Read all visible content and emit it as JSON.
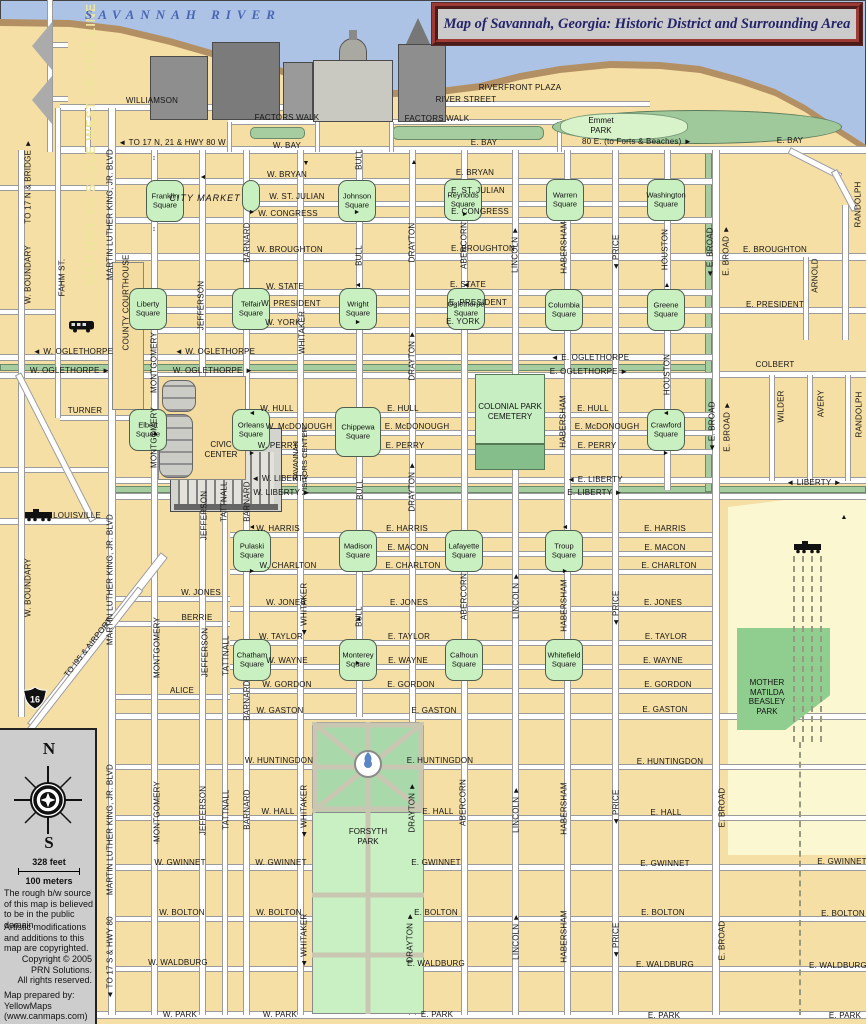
{
  "title": "Map of Savannah, Georgia: Historic District and Surrounding Area",
  "river_label": "SAVANNAH RIVER",
  "pois": {
    "city_market": "CITY MARKET",
    "emmet_park": "Emmet\nPARK",
    "civic_center": "CIVIC\nCENTER",
    "colonial_cemetery": "COLONIAL PARK\nCEMETERY",
    "forsyth_park": "FORSYTH\nPARK",
    "beasley_park": "MOTHER\nMATILDA\nBEASLEY\nPARK",
    "visitors_center": "SAVANNAH\nVISITORS CENTER",
    "interstate_16": "16",
    "map_note": "MAP NOT TO SCALE WEST OF THIS LINE"
  },
  "legend": {
    "north": "N",
    "south": "S",
    "scale_feet": "328 feet",
    "scale_meters": "100 meters",
    "source_note": "The rough b/w source of this map is believed to be in the public domain",
    "mods_note": "Artistic modifications and additions to this map are copyrighted.",
    "copyright": "Copyright © 2005\nPRN Solutions.\nAll rights reserved.",
    "prepared_by": "Map prepared by:\nYellowMaps\n(www.canmaps.com)"
  },
  "squares": [
    [
      "Franklin\nSquare",
      165,
      201
    ],
    [
      "Johnson\nSquare",
      357,
      201
    ],
    [
      "Reynolds\nSquare",
      463,
      200
    ],
    [
      "Warren\nSquare",
      565,
      200
    ],
    [
      "Washington\nSquare",
      666,
      200
    ],
    [
      "Liberty\nSquare",
      148,
      309
    ],
    [
      "Telfair\nSquare",
      251,
      309
    ],
    [
      "Wright\nSquare",
      358,
      309
    ],
    [
      "Oglethorpe\nSquare",
      466,
      309
    ],
    [
      "Columbia\nSquare",
      564,
      310
    ],
    [
      "Greene\nSquare",
      666,
      310
    ],
    [
      "Elbert\nSquare",
      148,
      430
    ],
    [
      "Orleans\nSquare",
      251,
      430
    ],
    [
      "Chippewa\nSquare",
      358,
      432,
      46,
      50
    ],
    [
      "Crawford\nSquare",
      666,
      430
    ],
    [
      "Pulaski\nSquare",
      252,
      551
    ],
    [
      "Madison\nSquare",
      358,
      551
    ],
    [
      "Lafayette\nSquare",
      464,
      551
    ],
    [
      "Troup\nSquare",
      564,
      551
    ],
    [
      "Chatham\nSquare",
      252,
      660
    ],
    [
      "Monterey\nSquare",
      358,
      660
    ],
    [
      "Calhoun\nSquare",
      464,
      660
    ],
    [
      "Whitefield\nSquare",
      564,
      660
    ]
  ],
  "street_labels": [
    [
      "WILLIAMSON",
      152,
      101
    ],
    [
      "◄ TO 17 N, 21 & HWY 80 W",
      172,
      143
    ],
    [
      "W. BAY",
      287,
      146
    ],
    [
      "E. BAY",
      484,
      143
    ],
    [
      "80 E. (to Forts & Beaches) ►",
      637,
      142
    ],
    [
      "E. BAY",
      790,
      141
    ],
    [
      "RIVERFRONT PLAZA",
      520,
      88
    ],
    [
      "RIVER STREET",
      466,
      100
    ],
    [
      "FACTORS WALK",
      287,
      118
    ],
    [
      "FACTORS WALK",
      437,
      119
    ],
    [
      "W. BRYAN",
      287,
      175
    ],
    [
      "E. BRYAN",
      475,
      173
    ],
    [
      "W. ST. JULIAN",
      297,
      197
    ],
    [
      "E. ST. JULIAN",
      478,
      191
    ],
    [
      "W. CONGRESS",
      288,
      214
    ],
    [
      "E. CONGRESS",
      480,
      212
    ],
    [
      "W. BROUGHTON",
      290,
      250
    ],
    [
      "E. BROUGHTON",
      483,
      249
    ],
    [
      "E. BROUGHTON",
      775,
      250
    ],
    [
      "W. STATE",
      285,
      287
    ],
    [
      "E. STATE",
      468,
      285
    ],
    [
      "W. PRESIDENT",
      291,
      304
    ],
    [
      "E. PRESIDENT",
      478,
      303
    ],
    [
      "E. PRESIDENT",
      775,
      305
    ],
    [
      "W. YORK",
      283,
      323
    ],
    [
      "E. YORK",
      463,
      322
    ],
    [
      "◄ W. OGLETHORPE",
      73,
      352
    ],
    [
      "W. OGLETHORPE ►",
      70,
      371
    ],
    [
      "◄ W. OGLETHORPE",
      215,
      352
    ],
    [
      "W. OGLETHORPE ►",
      213,
      371
    ],
    [
      "◄ E. OGLETHORPE",
      590,
      358
    ],
    [
      "E. OGLETHORPE ►",
      589,
      372
    ],
    [
      "COLBERT",
      775,
      365
    ],
    [
      "TURNER",
      85,
      411
    ],
    [
      "W. HULL",
      277,
      409
    ],
    [
      "E. HULL",
      403,
      409
    ],
    [
      "E. HULL",
      593,
      409
    ],
    [
      "W. McDONOUGH",
      299,
      427
    ],
    [
      "E. McDONOUGH",
      417,
      427
    ],
    [
      "E. McDONOUGH",
      607,
      427
    ],
    [
      "W. PERRY",
      278,
      446
    ],
    [
      "E. PERRY",
      405,
      446
    ],
    [
      "E. PERRY",
      597,
      446
    ],
    [
      "◄ W. LIBERTY",
      280,
      479
    ],
    [
      "W. LIBERTY ►",
      282,
      493
    ],
    [
      "◄ E. LIBERTY",
      595,
      480
    ],
    [
      "E. LIBERTY ►",
      595,
      493
    ],
    [
      "◄ LIBERTY ►",
      814,
      483
    ],
    [
      "LOUISVILLE",
      77,
      516
    ],
    [
      "W. HARRIS",
      278,
      529
    ],
    [
      "E. HARRIS",
      407,
      529
    ],
    [
      "E. HARRIS",
      665,
      529
    ],
    [
      "E. MACON",
      408,
      548
    ],
    [
      "E. MACON",
      665,
      548
    ],
    [
      "W. CHARLTON",
      288,
      566
    ],
    [
      "E. CHARLTON",
      413,
      566
    ],
    [
      "E. CHARLTON",
      669,
      566
    ],
    [
      "W. JONES",
      201,
      593
    ],
    [
      "W. JONES",
      286,
      603
    ],
    [
      "E. JONES",
      409,
      603
    ],
    [
      "E. JONES",
      663,
      603
    ],
    [
      "BERRIE",
      197,
      618
    ],
    [
      "W. TAYLOR",
      281,
      637
    ],
    [
      "E. TAYLOR",
      409,
      637
    ],
    [
      "E. TAYLOR",
      666,
      637
    ],
    [
      "W. WAYNE",
      287,
      661
    ],
    [
      "E. WAYNE",
      408,
      661
    ],
    [
      "E. WAYNE",
      663,
      661
    ],
    [
      "W. GORDON",
      287,
      685
    ],
    [
      "E. GORDON",
      411,
      685
    ],
    [
      "E. GORDON",
      668,
      685
    ],
    [
      "ALICE",
      182,
      691
    ],
    [
      "W. GASTON",
      280,
      711
    ],
    [
      "E. GASTON",
      434,
      711
    ],
    [
      "E. GASTON",
      665,
      710
    ],
    [
      "W. HUNTINGDON",
      279,
      761
    ],
    [
      "E. HUNTINGDON",
      440,
      761
    ],
    [
      "E. HUNTINGDON",
      670,
      762
    ],
    [
      "W. HALL",
      278,
      812
    ],
    [
      "E. HALL",
      438,
      812
    ],
    [
      "E. HALL",
      666,
      813
    ],
    [
      "W. GWINNET",
      180,
      863
    ],
    [
      "W. GWINNET",
      281,
      863
    ],
    [
      "E. GWINNET",
      436,
      863
    ],
    [
      "E. GWINNET",
      665,
      864
    ],
    [
      "E. GWINNET",
      842,
      862
    ],
    [
      "W. BOLTON",
      182,
      913
    ],
    [
      "W. BOLTON",
      279,
      913
    ],
    [
      "E. BOLTON",
      436,
      913
    ],
    [
      "E. BOLTON",
      663,
      913
    ],
    [
      "E. BOLTON",
      843,
      914
    ],
    [
      "W. WALDBURG",
      178,
      963
    ],
    [
      "E. WALDBURG",
      436,
      964
    ],
    [
      "E. WALDBURG",
      665,
      965
    ],
    [
      "E. WALDBURG",
      838,
      966
    ],
    [
      "W. PARK",
      180,
      1015
    ],
    [
      "W. PARK",
      280,
      1015
    ],
    [
      "E. PARK",
      437,
      1015
    ],
    [
      "E. PARK",
      664,
      1016
    ],
    [
      "E. PARK",
      845,
      1016
    ]
  ],
  "street_labels_vertical": [
    [
      "TO 17 N & BRIDGE ►",
      28,
      182
    ],
    [
      "W. BOUNDARY",
      28,
      275
    ],
    [
      "W. BOUNDARY",
      28,
      588
    ],
    [
      "FAHM ST.",
      62,
      278
    ],
    [
      "MARTIN LUTHER KING, JR. BLVD",
      110,
      215
    ],
    [
      "MARTIN LUTHER KING, JR. BLVD",
      110,
      580
    ],
    [
      "MARTIN LUTHER KING, JR. BLVD",
      110,
      830
    ],
    [
      "MONTGOMERY",
      154,
      363
    ],
    [
      "MONTGOMERY",
      154,
      438
    ],
    [
      "MONTGOMERY",
      157,
      648
    ],
    [
      "MONTGOMERY",
      157,
      812
    ],
    [
      "COUNTY COURTHOUSE",
      126,
      303
    ],
    [
      "JEFFERSON",
      201,
      306
    ],
    [
      "JEFFERSON",
      204,
      516
    ],
    [
      "JEFFERSON",
      205,
      653
    ],
    [
      "JEFFERSON",
      203,
      811
    ],
    [
      "TATTNALL",
      224,
      502
    ],
    [
      "TATTNALL",
      226,
      656
    ],
    [
      "TATTNALL",
      226,
      810
    ],
    [
      "BARNARD",
      247,
      243
    ],
    [
      "BARNARD",
      247,
      502
    ],
    [
      "BARNARD",
      247,
      701
    ],
    [
      "BARNARD",
      247,
      810
    ],
    [
      "WHITAKER",
      302,
      333
    ],
    [
      "◄ WHITAKER",
      304,
      610
    ],
    [
      "◄ WHITAKER",
      304,
      812
    ],
    [
      "◄ WHITAKER",
      304,
      941
    ],
    [
      "BULL",
      359,
      160
    ],
    [
      "BULL",
      359,
      256
    ],
    [
      "BULL",
      360,
      490
    ],
    [
      "BULL",
      359,
      617
    ],
    [
      "DRAYTON",
      412,
      243
    ],
    [
      "DRAYTON ►",
      412,
      356
    ],
    [
      "DRAYTON ►",
      412,
      487
    ],
    [
      "DRAYTON ►",
      412,
      808
    ],
    [
      "DRAYTON ►",
      410,
      938
    ],
    [
      "ABERCORN",
      464,
      246
    ],
    [
      "ABERCORN",
      464,
      597
    ],
    [
      "ABERCORN",
      463,
      803
    ],
    [
      "LINCOLN ►",
      515,
      250
    ],
    [
      "LINCOLN ►",
      516,
      596
    ],
    [
      "LINCOLN ►",
      516,
      810
    ],
    [
      "LINCOLN ►",
      516,
      937
    ],
    [
      "HABERSHAM",
      564,
      248
    ],
    [
      "HABERSHAM",
      563,
      422
    ],
    [
      "HABERSHAM",
      564,
      606
    ],
    [
      "HABERSHAM",
      564,
      809
    ],
    [
      "HABERSHAM",
      564,
      937
    ],
    [
      "◄ PRICE",
      616,
      253
    ],
    [
      "◄ PRICE",
      616,
      609
    ],
    [
      "◄ PRICE",
      616,
      808
    ],
    [
      "◄ PRICE",
      616,
      941
    ],
    [
      "HOUSTON",
      665,
      250
    ],
    [
      "HOUSTON",
      667,
      375
    ],
    [
      "◄ E. BROAD",
      710,
      253
    ],
    [
      "E. BROAD ►",
      726,
      251
    ],
    [
      "◄ E. BROAD",
      712,
      427
    ],
    [
      "E. BROAD ►",
      727,
      427
    ],
    [
      "E. BROAD",
      722,
      808
    ],
    [
      "E. BROAD",
      722,
      941
    ],
    [
      "RANDOLPH",
      858,
      205
    ],
    [
      "RANDOLPH",
      859,
      415
    ],
    [
      "ARNOLD",
      815,
      276
    ],
    [
      "WILDER",
      781,
      407
    ],
    [
      "AVERY",
      821,
      404
    ],
    [
      "◄ TO 17 S & HWY 80",
      110,
      958
    ]
  ],
  "street_labels_diagonal": [
    [
      "TO I95 & AIRPORT",
      88,
      648,
      -52
    ]
  ],
  "arrows": [
    [
      "▼",
      306,
      164
    ],
    [
      "▲",
      414,
      163
    ],
    [
      "↕",
      154,
      159
    ],
    [
      "↕",
      154,
      230
    ],
    [
      "↕",
      157,
      843
    ],
    [
      "◄",
      203,
      178
    ],
    [
      "►",
      252,
      213
    ],
    [
      "►",
      357,
      213
    ],
    [
      "►",
      465,
      215
    ],
    [
      "◄",
      358,
      286
    ],
    [
      "►",
      358,
      323
    ],
    [
      "◄",
      466,
      286
    ],
    [
      "▲",
      667,
      286
    ],
    [
      "▲",
      155,
      434
    ],
    [
      "◄",
      666,
      414
    ],
    [
      "►",
      666,
      454
    ],
    [
      "◄",
      252,
      414
    ],
    [
      "►",
      252,
      454
    ],
    [
      "◄",
      565,
      528
    ],
    [
      "►",
      565,
      572
    ],
    [
      "◄",
      252,
      528
    ],
    [
      "►",
      252,
      572
    ],
    [
      "◄",
      358,
      620
    ],
    [
      "►",
      358,
      664
    ],
    [
      "▲",
      844,
      518
    ]
  ]
}
